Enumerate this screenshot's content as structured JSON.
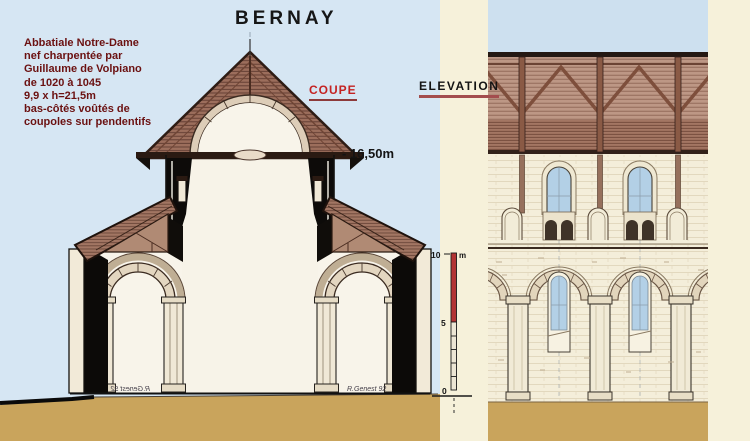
{
  "title": "BERNAY",
  "info_block": {
    "lines": [
      "Abbatiale Notre-Dame",
      "nef charpentée par",
      "Guillaume de Volpiano",
      "de 1020 à 1045",
      "9,9 x h=21,5m",
      "bas-côtés voûtés de",
      "coupoles sur pendentifs"
    ]
  },
  "section_labels": {
    "coupe": "COUPE",
    "elevation": "ELEVATION"
  },
  "annotations": {
    "height_marker": "- 16,50m"
  },
  "scale_bar": {
    "top_value": "10",
    "unit": "m",
    "mid_value": "5",
    "bottom_value": "0"
  },
  "signatures": {
    "left_mirrored": "R.Genest 92",
    "right": "R.Genest 92"
  },
  "colors": {
    "background_blue": "#d6e6f3",
    "background_cream": "#f6f1da",
    "sky_blue": "#cde0ef",
    "ground_tan": "#c9a45c",
    "text_maroon": "#6b1111",
    "accent_red": "#c42222",
    "underline_red": "#9a4040",
    "scale_red": "#b23434",
    "roof_brown": "#9c6e5c"
  }
}
